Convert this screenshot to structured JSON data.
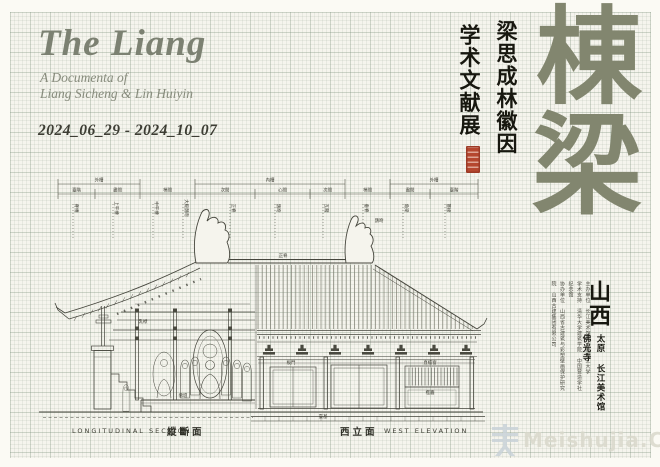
{
  "header": {
    "title": "The Liang",
    "subtitle_line1": "A Documenta of",
    "subtitle_line2": "Liang Sicheng & Lin Huiyin",
    "dates": "2024_06_29 - 2024_10_07"
  },
  "headline": {
    "col_right": "梁思成林徽因",
    "col_left": "学术文献展",
    "calligraphy_char1": "棟",
    "calligraphy_char2": "梁"
  },
  "venue": {
    "region": "山西",
    "line_city": "太原 长江美术馆",
    "line_site": "佛光寺",
    "credits": [
      "主办单位 长江美术馆 太原理工大学",
      "学术支持 清华大学建筑学院 中国营造学社纪念馆",
      "协办单位 山西省古建筑与彩塑壁画保护研究院 山西古建集团有限公司"
    ]
  },
  "drawing": {
    "caption_left_en": "LONGITUDINAL SECTION",
    "caption_left_zh": "縱斷面",
    "caption_right_zh": "西立面",
    "caption_right_en": "WEST ELEVATION",
    "span_labels": [
      "外槽",
      "內槽",
      "外槽"
    ],
    "bay_labels": [
      "臺階",
      "盡間",
      "梢間",
      "次間",
      "心間",
      "次間",
      "梢間",
      "盡間",
      "臺階"
    ],
    "leader_labels": [
      "脊槫",
      "上平槫",
      "中平槫",
      "大殿鴟吻",
      "正脊",
      "鴟吻",
      "瓦隴",
      "垂脊",
      "角梁",
      "簷椽"
    ],
    "part_labels": [
      {
        "text": "佛壇",
        "x": 158,
        "y": 237
      },
      {
        "text": "乳栿",
        "x": 118,
        "y": 163
      },
      {
        "text": "板門",
        "x": 266,
        "y": 204
      },
      {
        "text": "直櫺窗",
        "x": 405,
        "y": 204
      },
      {
        "text": "檻牆",
        "x": 405,
        "y": 234
      },
      {
        "text": "臺基",
        "x": 298,
        "y": 258
      },
      {
        "text": "正脊",
        "x": 258,
        "y": 97
      },
      {
        "text": "鴟吻",
        "x": 354,
        "y": 62
      }
    ]
  },
  "watermark": {
    "text": "Meishujia.Cn"
  },
  "colors": {
    "accent_olive": "#82866f",
    "seal_red": "#b5472f",
    "ink": "#17170f",
    "drawing_line": "#4a4a40"
  }
}
